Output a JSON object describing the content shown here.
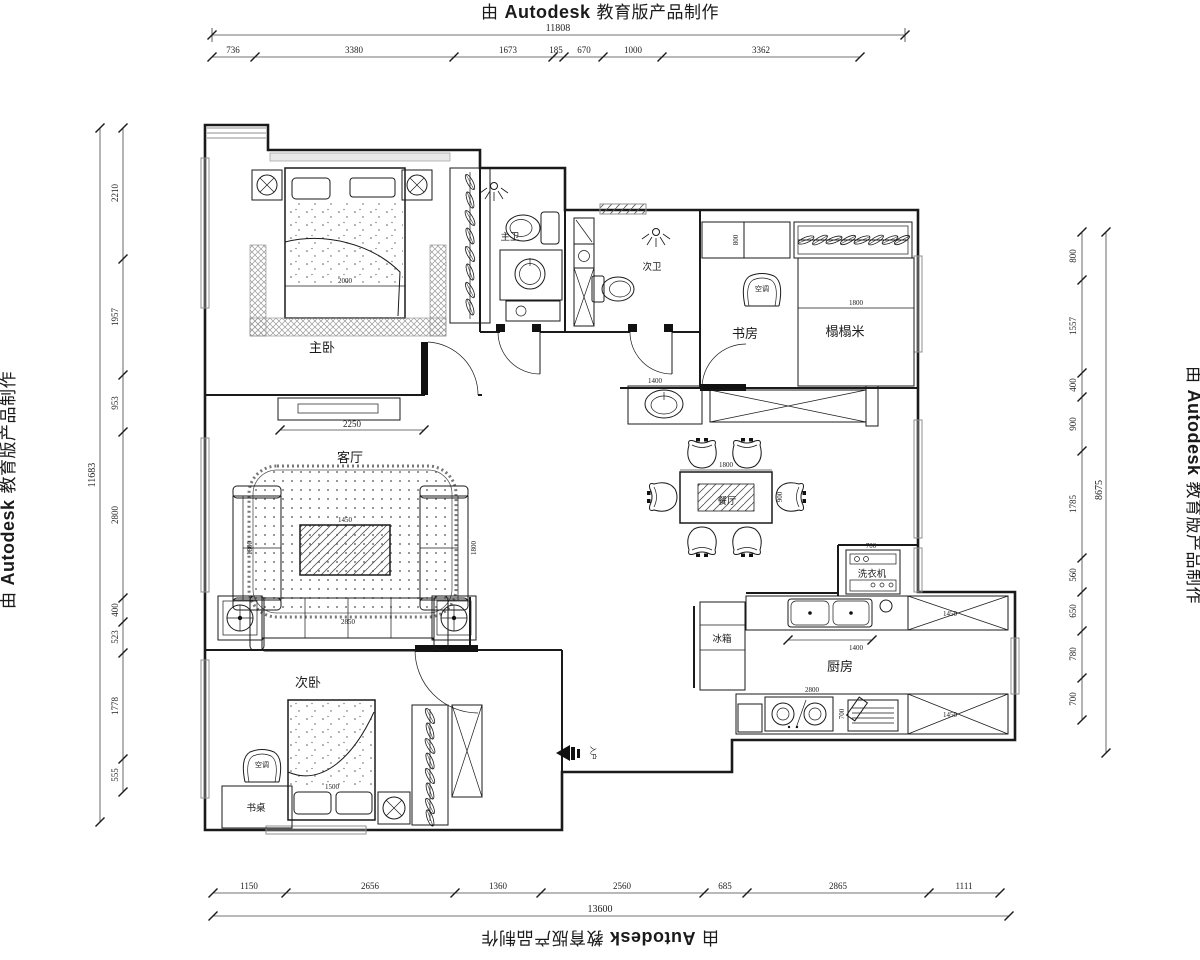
{
  "watermarks": {
    "prefix": "由",
    "brand": "Autodesk",
    "suffix": "教育版产品制作"
  },
  "dims": {
    "top": {
      "total": "11808",
      "segs": [
        "736",
        "3380",
        "1673",
        "185",
        "670",
        "1000",
        "3362"
      ]
    },
    "bottom": {
      "total": "13600",
      "segs": [
        "1150",
        "2656",
        "1360",
        "2560",
        "685",
        "2865",
        "1111"
      ]
    },
    "left": {
      "total": "11683",
      "segs": [
        "2210",
        "1957",
        "953",
        "2800",
        "400",
        "523",
        "1778",
        "555"
      ]
    },
    "right": {
      "total": "8675",
      "segs": [
        "800",
        "1557",
        "400",
        "900",
        "1785",
        "560",
        "650",
        "780",
        "700"
      ]
    }
  },
  "rooms": {
    "master_bedroom": "主卧",
    "master_bath": "主卫",
    "second_bath": "次卫",
    "study": "书房",
    "tatami": "榻榻米",
    "living": "客厅",
    "dining": "餐厅",
    "kitchen": "厨房",
    "second_bedroom": "次卧",
    "desk": "书桌",
    "fridge": "冰箱",
    "washer": "洗衣机",
    "ac": "空调",
    "entry": "入户"
  },
  "furniture_dims": {
    "master_bed_width": "2000",
    "tv_wall": "2250",
    "sofa_side_left": "1800",
    "sofa_side_right": "1800",
    "coffee_table": "1450",
    "sofa_long": "2850",
    "dining_length": "1800",
    "dining_width": "900",
    "hall_cabinet": "1400",
    "washer_width": "700",
    "sink_counter": "1400",
    "cabinet_upper": "1450",
    "cabinet_lower": "1450",
    "stove_counter": "2800",
    "stove_depth": "700",
    "tatami_width": "1800",
    "study_cabinet": "800",
    "bed2_pillow": "1500"
  }
}
